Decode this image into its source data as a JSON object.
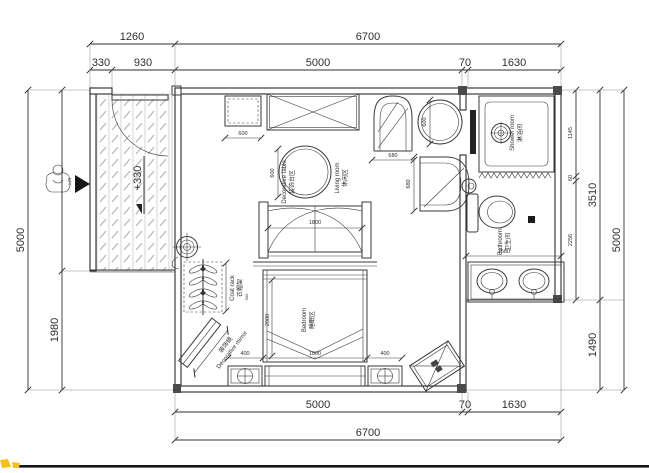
{
  "page": {
    "footer_bar_color": "#151515",
    "watermark_color": "#f4c21d",
    "ink_color": "#303030"
  },
  "plan": {
    "dims": {
      "top_1260": "1260",
      "top_6700": "6700",
      "top_330": "330",
      "top_930": "930",
      "top_5000": "5000",
      "top_70": "70",
      "top_1630": "1630",
      "bottom_5000": "5000",
      "bottom_70": "70",
      "bottom_1630": "1630",
      "bottom_6700": "6700",
      "left_5000": "5000",
      "left_1980": "1980",
      "right_1145": "1145",
      "right_60": "60",
      "right_2256": "2256",
      "right_3510": "3510",
      "right_1490": "1490",
      "right_5000": "5000"
    },
    "entry": {
      "level": "+330",
      "label_zh": "入口"
    },
    "living": {
      "zone_zh": "休闲区",
      "zone_en": "Living room",
      "table_zh": "装饰台区",
      "table_en": "Decorative table",
      "cabinet_dim": "600",
      "table_dim": "600",
      "chair_left_dim": "680",
      "chair_round_dim": "600",
      "chair_right_dim": "680"
    },
    "bedroom": {
      "zone_zh": "睡眠区",
      "zone_en": "Bedroom",
      "window_dim": "1800",
      "bed_width": "1800",
      "bed_length": "2000",
      "nightstand_left_dim": "400",
      "nightstand_right_dim": "400",
      "coatrack_zh": "衣帽架",
      "coatrack_en": "Coat rack",
      "coatrack_dim": "900",
      "mirror_zh": "装饰镜",
      "mirror_en": "Decorative mirror"
    },
    "bath": {
      "shower_zh": "淋浴间",
      "shower_en": "Shower room",
      "wc_zh": "卫生间",
      "wc_en": "Bathroom",
      "width_dim": "1580"
    }
  }
}
